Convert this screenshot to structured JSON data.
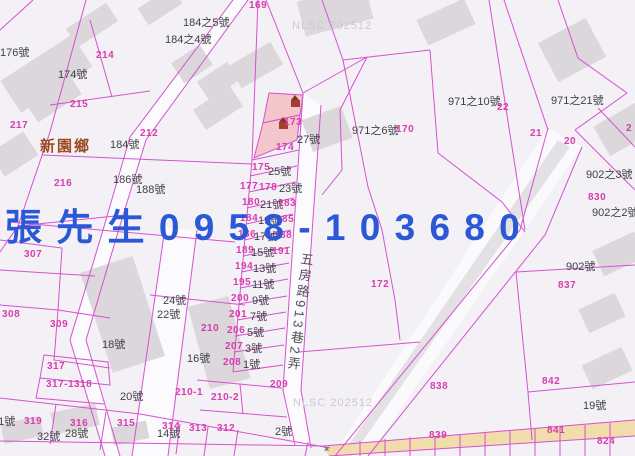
{
  "overlay": {
    "text": "張 先 生 0 9 5 8 - 1 0 3 6 8 0",
    "color": "#2b58d6",
    "x": 5,
    "y": 197
  },
  "township_label": {
    "text": "新園鄉",
    "x": 40,
    "y": 135
  },
  "street_label": {
    "text": "五房路913巷2弄",
    "x": 290,
    "y": 252
  },
  "watermarks": [
    {
      "t": "NLSC 202512",
      "x": 292,
      "y": 20
    },
    {
      "t": "NLSC 202512",
      "x": 293,
      "y": 397
    }
  ],
  "markers": [
    {
      "t": "×",
      "x": 324,
      "y": 444
    }
  ],
  "icons": [
    {
      "name": "building-icon",
      "x": 291,
      "y": 100
    },
    {
      "name": "building-icon",
      "x": 279,
      "y": 122
    }
  ],
  "colors": {
    "parcel_line": "#d552d0",
    "house_text": "#3f3f46",
    "parcel_text": "#d93cae",
    "road_fill": "#f1dcab",
    "selected_parcel_fill": "#f2c6cb",
    "watermark": "#cbc9cf",
    "overlay_blue": "#2b58d6"
  },
  "house_labels": [
    {
      "t": "184之5號",
      "x": 183,
      "y": 14
    },
    {
      "t": "184之4號",
      "x": 165,
      "y": 31
    },
    {
      "t": "176號",
      "x": 0,
      "y": 44
    },
    {
      "t": "174號",
      "x": 58,
      "y": 66
    },
    {
      "t": "184號",
      "x": 110,
      "y": 136
    },
    {
      "t": "186號",
      "x": 113,
      "y": 171
    },
    {
      "t": "188號",
      "x": 136,
      "y": 181
    },
    {
      "t": "27號",
      "x": 297,
      "y": 131
    },
    {
      "t": "25號",
      "x": 268,
      "y": 163
    },
    {
      "t": "23號",
      "x": 279,
      "y": 180
    },
    {
      "t": "21號",
      "x": 260,
      "y": 196
    },
    {
      "t": "19號",
      "x": 258,
      "y": 212
    },
    {
      "t": "17號",
      "x": 254,
      "y": 228
    },
    {
      "t": "15號",
      "x": 251,
      "y": 244
    },
    {
      "t": "13號",
      "x": 253,
      "y": 260
    },
    {
      "t": "11號",
      "x": 252,
      "y": 276
    },
    {
      "t": "9號",
      "x": 252,
      "y": 292
    },
    {
      "t": "7號",
      "x": 250,
      "y": 308
    },
    {
      "t": "5號",
      "x": 247,
      "y": 324
    },
    {
      "t": "3號",
      "x": 245,
      "y": 340
    },
    {
      "t": "1號",
      "x": 243,
      "y": 356
    },
    {
      "t": "971之10號",
      "x": 448,
      "y": 93
    },
    {
      "t": "971之21號",
      "x": 551,
      "y": 92
    },
    {
      "t": "971之6號",
      "x": 352,
      "y": 122
    },
    {
      "t": "902之3號",
      "x": 586,
      "y": 166
    },
    {
      "t": "902之2號",
      "x": 592,
      "y": 204
    },
    {
      "t": "902號",
      "x": 566,
      "y": 258
    },
    {
      "t": "24號",
      "x": 163,
      "y": 292
    },
    {
      "t": "22號",
      "x": 157,
      "y": 306
    },
    {
      "t": "18號",
      "x": 102,
      "y": 336
    },
    {
      "t": "16號",
      "x": 187,
      "y": 350
    },
    {
      "t": "20號",
      "x": 120,
      "y": 388
    },
    {
      "t": "31號",
      "x": -8,
      "y": 413
    },
    {
      "t": "32號",
      "x": 37,
      "y": 428
    },
    {
      "t": "28號",
      "x": 65,
      "y": 425
    },
    {
      "t": "14號",
      "x": 157,
      "y": 425
    },
    {
      "t": "2號",
      "x": 275,
      "y": 423
    },
    {
      "t": "19號",
      "x": 583,
      "y": 397
    }
  ],
  "parcel_labels": [
    {
      "t": "169",
      "x": 249,
      "y": 0
    },
    {
      "t": "214",
      "x": 96,
      "y": 50
    },
    {
      "t": "215",
      "x": 70,
      "y": 99
    },
    {
      "t": "217",
      "x": 10,
      "y": 120
    },
    {
      "t": "212",
      "x": 140,
      "y": 128
    },
    {
      "t": "216",
      "x": 54,
      "y": 178
    },
    {
      "t": "173",
      "x": 284,
      "y": 117
    },
    {
      "t": "174",
      "x": 276,
      "y": 142
    },
    {
      "t": "175",
      "x": 252,
      "y": 162
    },
    {
      "t": "177",
      "x": 240,
      "y": 181
    },
    {
      "t": "178",
      "x": 259,
      "y": 182
    },
    {
      "t": "180",
      "x": 242,
      "y": 197
    },
    {
      "t": "183",
      "x": 278,
      "y": 198
    },
    {
      "t": "184",
      "x": 240,
      "y": 213
    },
    {
      "t": "185",
      "x": 276,
      "y": 214
    },
    {
      "t": "186",
      "x": 238,
      "y": 229
    },
    {
      "t": "188",
      "x": 274,
      "y": 230
    },
    {
      "t": "189",
      "x": 236,
      "y": 245
    },
    {
      "t": "191",
      "x": 272,
      "y": 246
    },
    {
      "t": "194",
      "x": 235,
      "y": 261
    },
    {
      "t": "195",
      "x": 233,
      "y": 277
    },
    {
      "t": "200",
      "x": 231,
      "y": 293
    },
    {
      "t": "201",
      "x": 229,
      "y": 309
    },
    {
      "t": "206",
      "x": 227,
      "y": 325
    },
    {
      "t": "207",
      "x": 225,
      "y": 341
    },
    {
      "t": "208",
      "x": 223,
      "y": 357
    },
    {
      "t": "170",
      "x": 396,
      "y": 124
    },
    {
      "t": "22",
      "x": 497,
      "y": 102
    },
    {
      "t": "21",
      "x": 530,
      "y": 128
    },
    {
      "t": "20",
      "x": 564,
      "y": 136
    },
    {
      "t": "2",
      "x": 626,
      "y": 123
    },
    {
      "t": "830",
      "x": 588,
      "y": 192
    },
    {
      "t": "172",
      "x": 371,
      "y": 279
    },
    {
      "t": "837",
      "x": 558,
      "y": 280
    },
    {
      "t": "838",
      "x": 430,
      "y": 381
    },
    {
      "t": "842",
      "x": 542,
      "y": 376
    },
    {
      "t": "307",
      "x": 24,
      "y": 249
    },
    {
      "t": "308",
      "x": 2,
      "y": 309
    },
    {
      "t": "309",
      "x": 50,
      "y": 319
    },
    {
      "t": "317",
      "x": 47,
      "y": 361
    },
    {
      "t": "317-1",
      "x": 46,
      "y": 379
    },
    {
      "t": "318",
      "x": 74,
      "y": 379
    },
    {
      "t": "319",
      "x": 24,
      "y": 416
    },
    {
      "t": "316",
      "x": 70,
      "y": 418
    },
    {
      "t": "315",
      "x": 117,
      "y": 418
    },
    {
      "t": "314",
      "x": 162,
      "y": 421
    },
    {
      "t": "313",
      "x": 189,
      "y": 423
    },
    {
      "t": "312",
      "x": 217,
      "y": 423
    },
    {
      "t": "210",
      "x": 201,
      "y": 323
    },
    {
      "t": "210-1",
      "x": 175,
      "y": 387
    },
    {
      "t": "210-2",
      "x": 211,
      "y": 392
    },
    {
      "t": "209",
      "x": 270,
      "y": 379
    },
    {
      "t": "839",
      "x": 429,
      "y": 430
    },
    {
      "t": "841",
      "x": 547,
      "y": 425
    },
    {
      "t": "824",
      "x": 597,
      "y": 436
    }
  ]
}
